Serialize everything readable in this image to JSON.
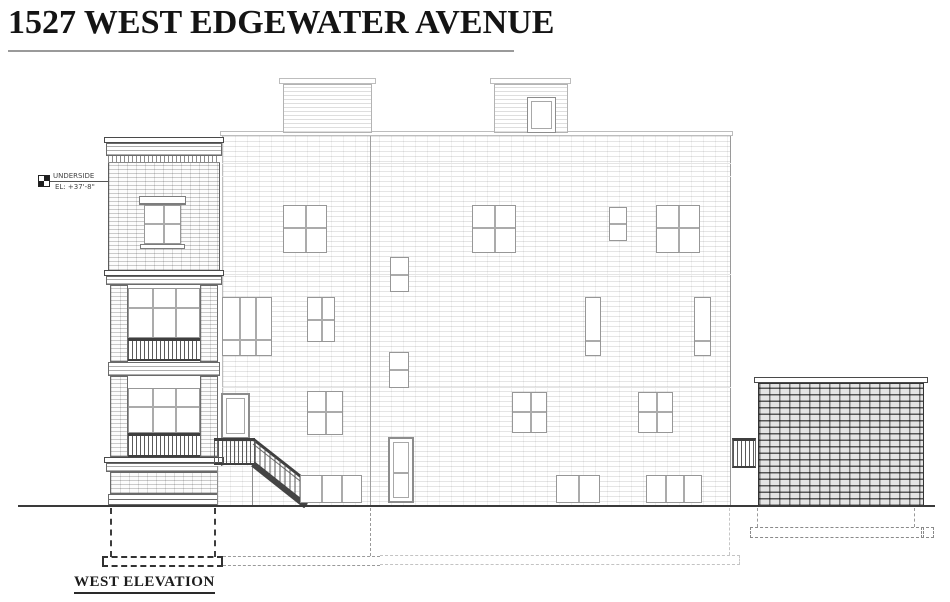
{
  "title": {
    "text": "1527 WEST EDGEWATER AVENUE"
  },
  "labels": {
    "elevation_name": "WEST ELEVATION"
  },
  "annotations": {
    "underside": {
      "line1": "UNDERSIDE",
      "line2": "EL:   +37'-8\""
    }
  },
  "colors": {
    "paper": "#ffffff",
    "ink_dark": "#2a2a2a",
    "ink_mid": "#8d8d8d",
    "ink_light": "#c6c6c6",
    "garage_brick_line": "#4a4a4a"
  }
}
